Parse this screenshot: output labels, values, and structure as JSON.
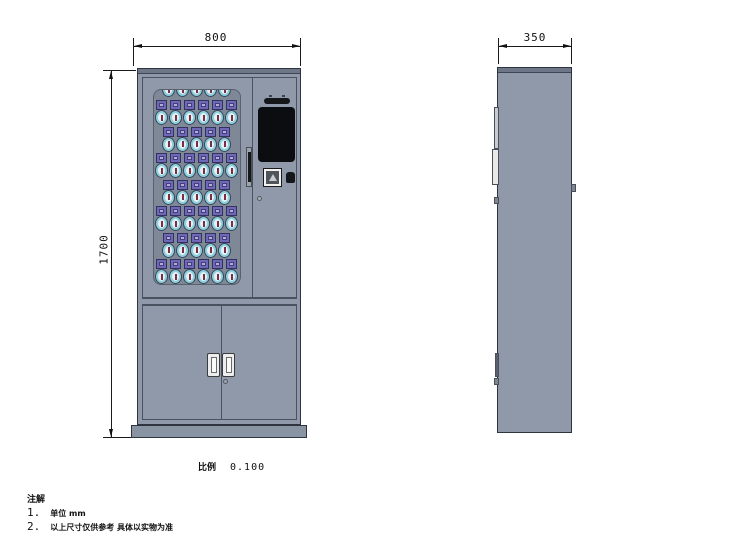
{
  "dimensions": {
    "front_width": "800",
    "front_height": "1700",
    "side_depth": "350"
  },
  "scale": {
    "label": "比例",
    "value": "0.100"
  },
  "notes": {
    "title": "注解",
    "items": [
      {
        "num": "1.",
        "text": "单位 mm"
      },
      {
        "num": "2.",
        "text": "以上尺寸仅供参考  具体以实物为准"
      }
    ]
  },
  "key_grid": {
    "rows": [
      {
        "count": 5,
        "partial_top": true,
        "offset": true
      },
      {
        "count": 6
      },
      {
        "count": 5,
        "offset": true
      },
      {
        "count": 6
      },
      {
        "count": 5,
        "offset": true
      },
      {
        "count": 6
      },
      {
        "count": 5,
        "offset": true
      },
      {
        "count": 6
      }
    ]
  },
  "colors": {
    "cabinet_body": "#8f99a9",
    "cabinet_strip": "#6d7787",
    "window_panel": "#7f8897",
    "key_slot": "#6f68b8",
    "key_slot_inner": "#b2acdf",
    "fob_ring": "#8ecfdb",
    "fob_slit": "#7c2c44",
    "screen": "#0b0d10",
    "line": "#1a1a1a"
  }
}
